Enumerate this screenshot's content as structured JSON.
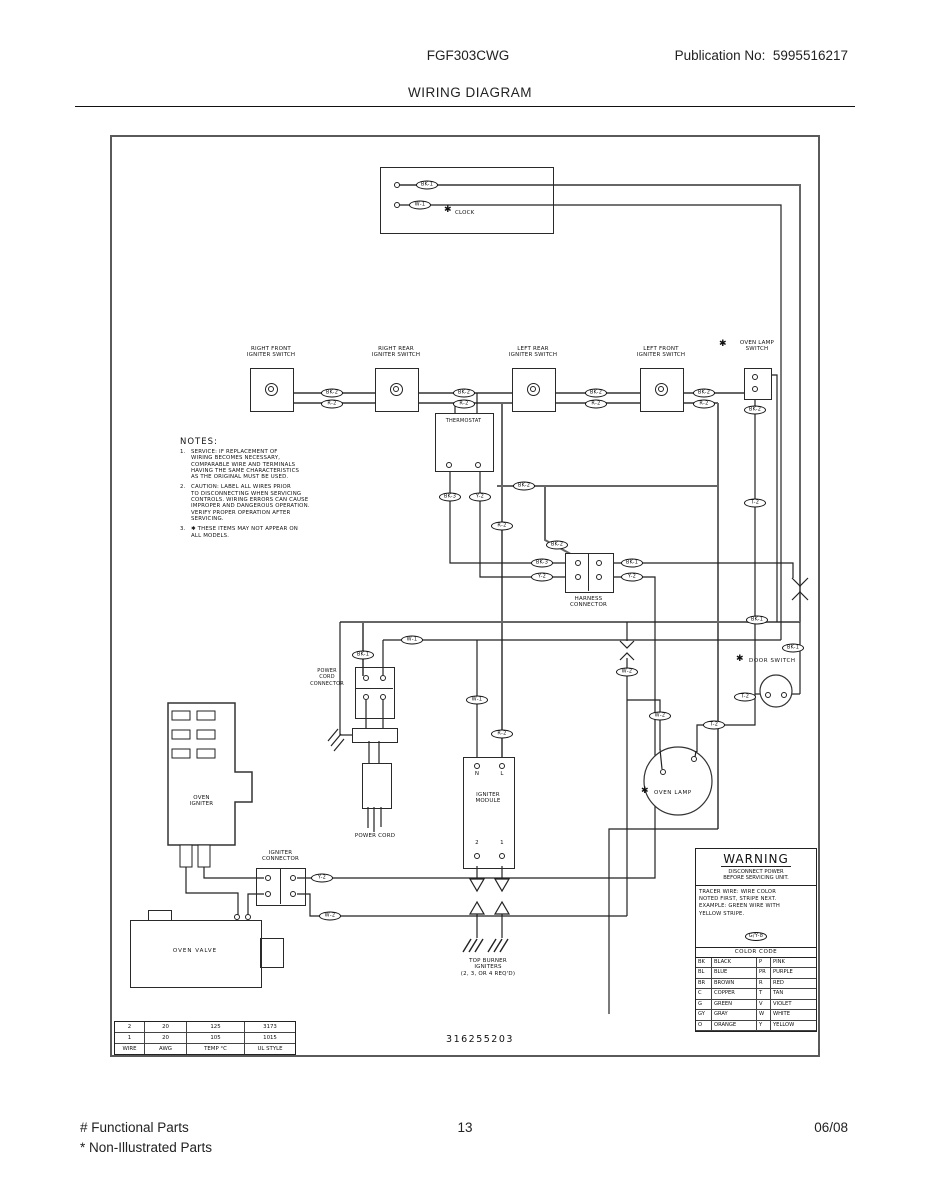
{
  "header": {
    "model": "FGF303CWG",
    "publication": "Publication No:  5995516217",
    "title": "WIRING DIAGRAM"
  },
  "footer": {
    "functional": "# Functional Parts",
    "non_illustrated": "* Non-Illustrated Parts",
    "page": "13",
    "date": "06/08"
  },
  "icons": {
    "asterisk": "✱"
  },
  "diagram": {
    "part_number": "316255203",
    "components": {
      "clock": "CLOCK",
      "oven_lamp_switch": "OVEN LAMP\nSWITCH",
      "thermostat": "THERMOSTAT",
      "harness_connector": "HARNESS\nCONNECTOR",
      "power_cord_connector": "POWER\nCORD\nCONNECTOR",
      "power_cord": "POWER CORD",
      "oven_igniter": "OVEN\nIGNITER",
      "igniter_connector": "IGNITER\nCONNECTOR",
      "oven_valve": "OVEN VALVE",
      "igniter_module": "IGNITER\nMODULE",
      "module_terminal_n": "N",
      "module_terminal_l": "L",
      "module_terminal_2": "2",
      "module_terminal_1": "1",
      "top_burner_igniters": "TOP BURNER\nIGNITERS\n(2, 3, OR 4 REQ'D)",
      "door_switch": "DOOR SWITCH",
      "oven_lamp": "OVEN LAMP"
    },
    "switches": [
      {
        "label": "RIGHT FRONT\nIGNITER SWITCH",
        "x": 250
      },
      {
        "label": "RIGHT REAR\nIGNITER SWITCH",
        "x": 375
      },
      {
        "label": "LEFT REAR\nIGNITER SWITCH",
        "x": 512
      },
      {
        "label": "LEFT FRONT\nIGNITER SWITCH",
        "x": 640
      }
    ],
    "notes": {
      "heading": "NOTES:",
      "items": [
        {
          "num": "1.",
          "text": "SERVICE:  IF REPLACEMENT OF\nWIRING BECOMES NECESSARY,\nCOMPARABLE WIRE AND TERMINALS\nHAVING THE SAME CHARACTERISTICS\nAS THE ORIGINAL MUST BE USED."
        },
        {
          "num": "2.",
          "text": "CAUTION:  LABEL ALL WIRES PRIOR\nTO DISCONNECTING WHEN SERVICING\nCONTROLS.  WIRING ERRORS CAN CAUSE\nIMPROPER AND DANGEROUS OPERATION.\nVERIFY PROPER OPERATION AFTER\nSERVICING."
        },
        {
          "num": "3.",
          "text": "✱ THESE ITEMS MAY NOT APPEAR ON\nALL MODELS."
        }
      ]
    },
    "warning": {
      "title": "WARNING",
      "subtitle": "DISCONNECT POWER\nBEFORE SERVICING UNIT.",
      "tracer": "TRACER WIRE:      WIRE COLOR\nNOTED FIRST, STRIPE NEXT.\nEXAMPLE:   GREEN WIRE WITH\nYELLOW STRIPE.",
      "example_label": "G/Y-8"
    },
    "color_code": {
      "title": "COLOR CODE",
      "rows": [
        [
          "BK",
          "BLACK",
          "P",
          "PINK"
        ],
        [
          "BL",
          "BLUE",
          "PR",
          "PURPLE"
        ],
        [
          "BR",
          "BROWN",
          "R",
          "RED"
        ],
        [
          "C",
          "COPPER",
          "T",
          "TAN"
        ],
        [
          "G",
          "GREEN",
          "V",
          "VIOLET"
        ],
        [
          "GY",
          "GRAY",
          "W",
          "WHITE"
        ],
        [
          "O",
          "ORANGE",
          "Y",
          "YELLOW"
        ]
      ]
    },
    "wire_table": {
      "rows": [
        [
          "2",
          "20",
          "125",
          "3173"
        ],
        [
          "1",
          "20",
          "105",
          "1015"
        ],
        [
          "WIRE",
          "AWG",
          "TEMP °C",
          "UL STYLE"
        ]
      ]
    },
    "wire_labels": [
      {
        "text": "BK-1",
        "x": 427,
        "y": 185
      },
      {
        "text": "W-1",
        "x": 420,
        "y": 205
      },
      {
        "text": "BK-2",
        "x": 332,
        "y": 393
      },
      {
        "text": "R-2",
        "x": 332,
        "y": 404
      },
      {
        "text": "BK-2",
        "x": 464,
        "y": 393
      },
      {
        "text": "R-2",
        "x": 464,
        "y": 404
      },
      {
        "text": "BK-2",
        "x": 596,
        "y": 393
      },
      {
        "text": "R-2",
        "x": 596,
        "y": 404
      },
      {
        "text": "BK-2",
        "x": 704,
        "y": 393
      },
      {
        "text": "R-2",
        "x": 704,
        "y": 404
      },
      {
        "text": "BK-2",
        "x": 755,
        "y": 410
      },
      {
        "text": "BK-2",
        "x": 524,
        "y": 486
      },
      {
        "text": "BK-3",
        "x": 450,
        "y": 497
      },
      {
        "text": "Y-2",
        "x": 480,
        "y": 497
      },
      {
        "text": "T-2",
        "x": 755,
        "y": 503
      },
      {
        "text": "R-2",
        "x": 502,
        "y": 526
      },
      {
        "text": "BK-2",
        "x": 557,
        "y": 545
      },
      {
        "text": "BK-3",
        "x": 542,
        "y": 563
      },
      {
        "text": "Y-2",
        "x": 542,
        "y": 577
      },
      {
        "text": "BK-1",
        "x": 632,
        "y": 563
      },
      {
        "text": "Y-2",
        "x": 632,
        "y": 577
      },
      {
        "text": "BK-1",
        "x": 757,
        "y": 620
      },
      {
        "text": "W-1",
        "x": 412,
        "y": 640
      },
      {
        "text": "BK-1",
        "x": 363,
        "y": 655
      },
      {
        "text": "BK-1",
        "x": 793,
        "y": 648
      },
      {
        "text": "W-2",
        "x": 627,
        "y": 672
      },
      {
        "text": "W-1",
        "x": 477,
        "y": 700
      },
      {
        "text": "T-2",
        "x": 745,
        "y": 697
      },
      {
        "text": "W-2",
        "x": 660,
        "y": 716
      },
      {
        "text": "T-2",
        "x": 714,
        "y": 725
      },
      {
        "text": "R-2",
        "x": 502,
        "y": 734
      },
      {
        "text": "Y-2",
        "x": 322,
        "y": 878
      },
      {
        "text": "W-2",
        "x": 330,
        "y": 916
      }
    ]
  }
}
